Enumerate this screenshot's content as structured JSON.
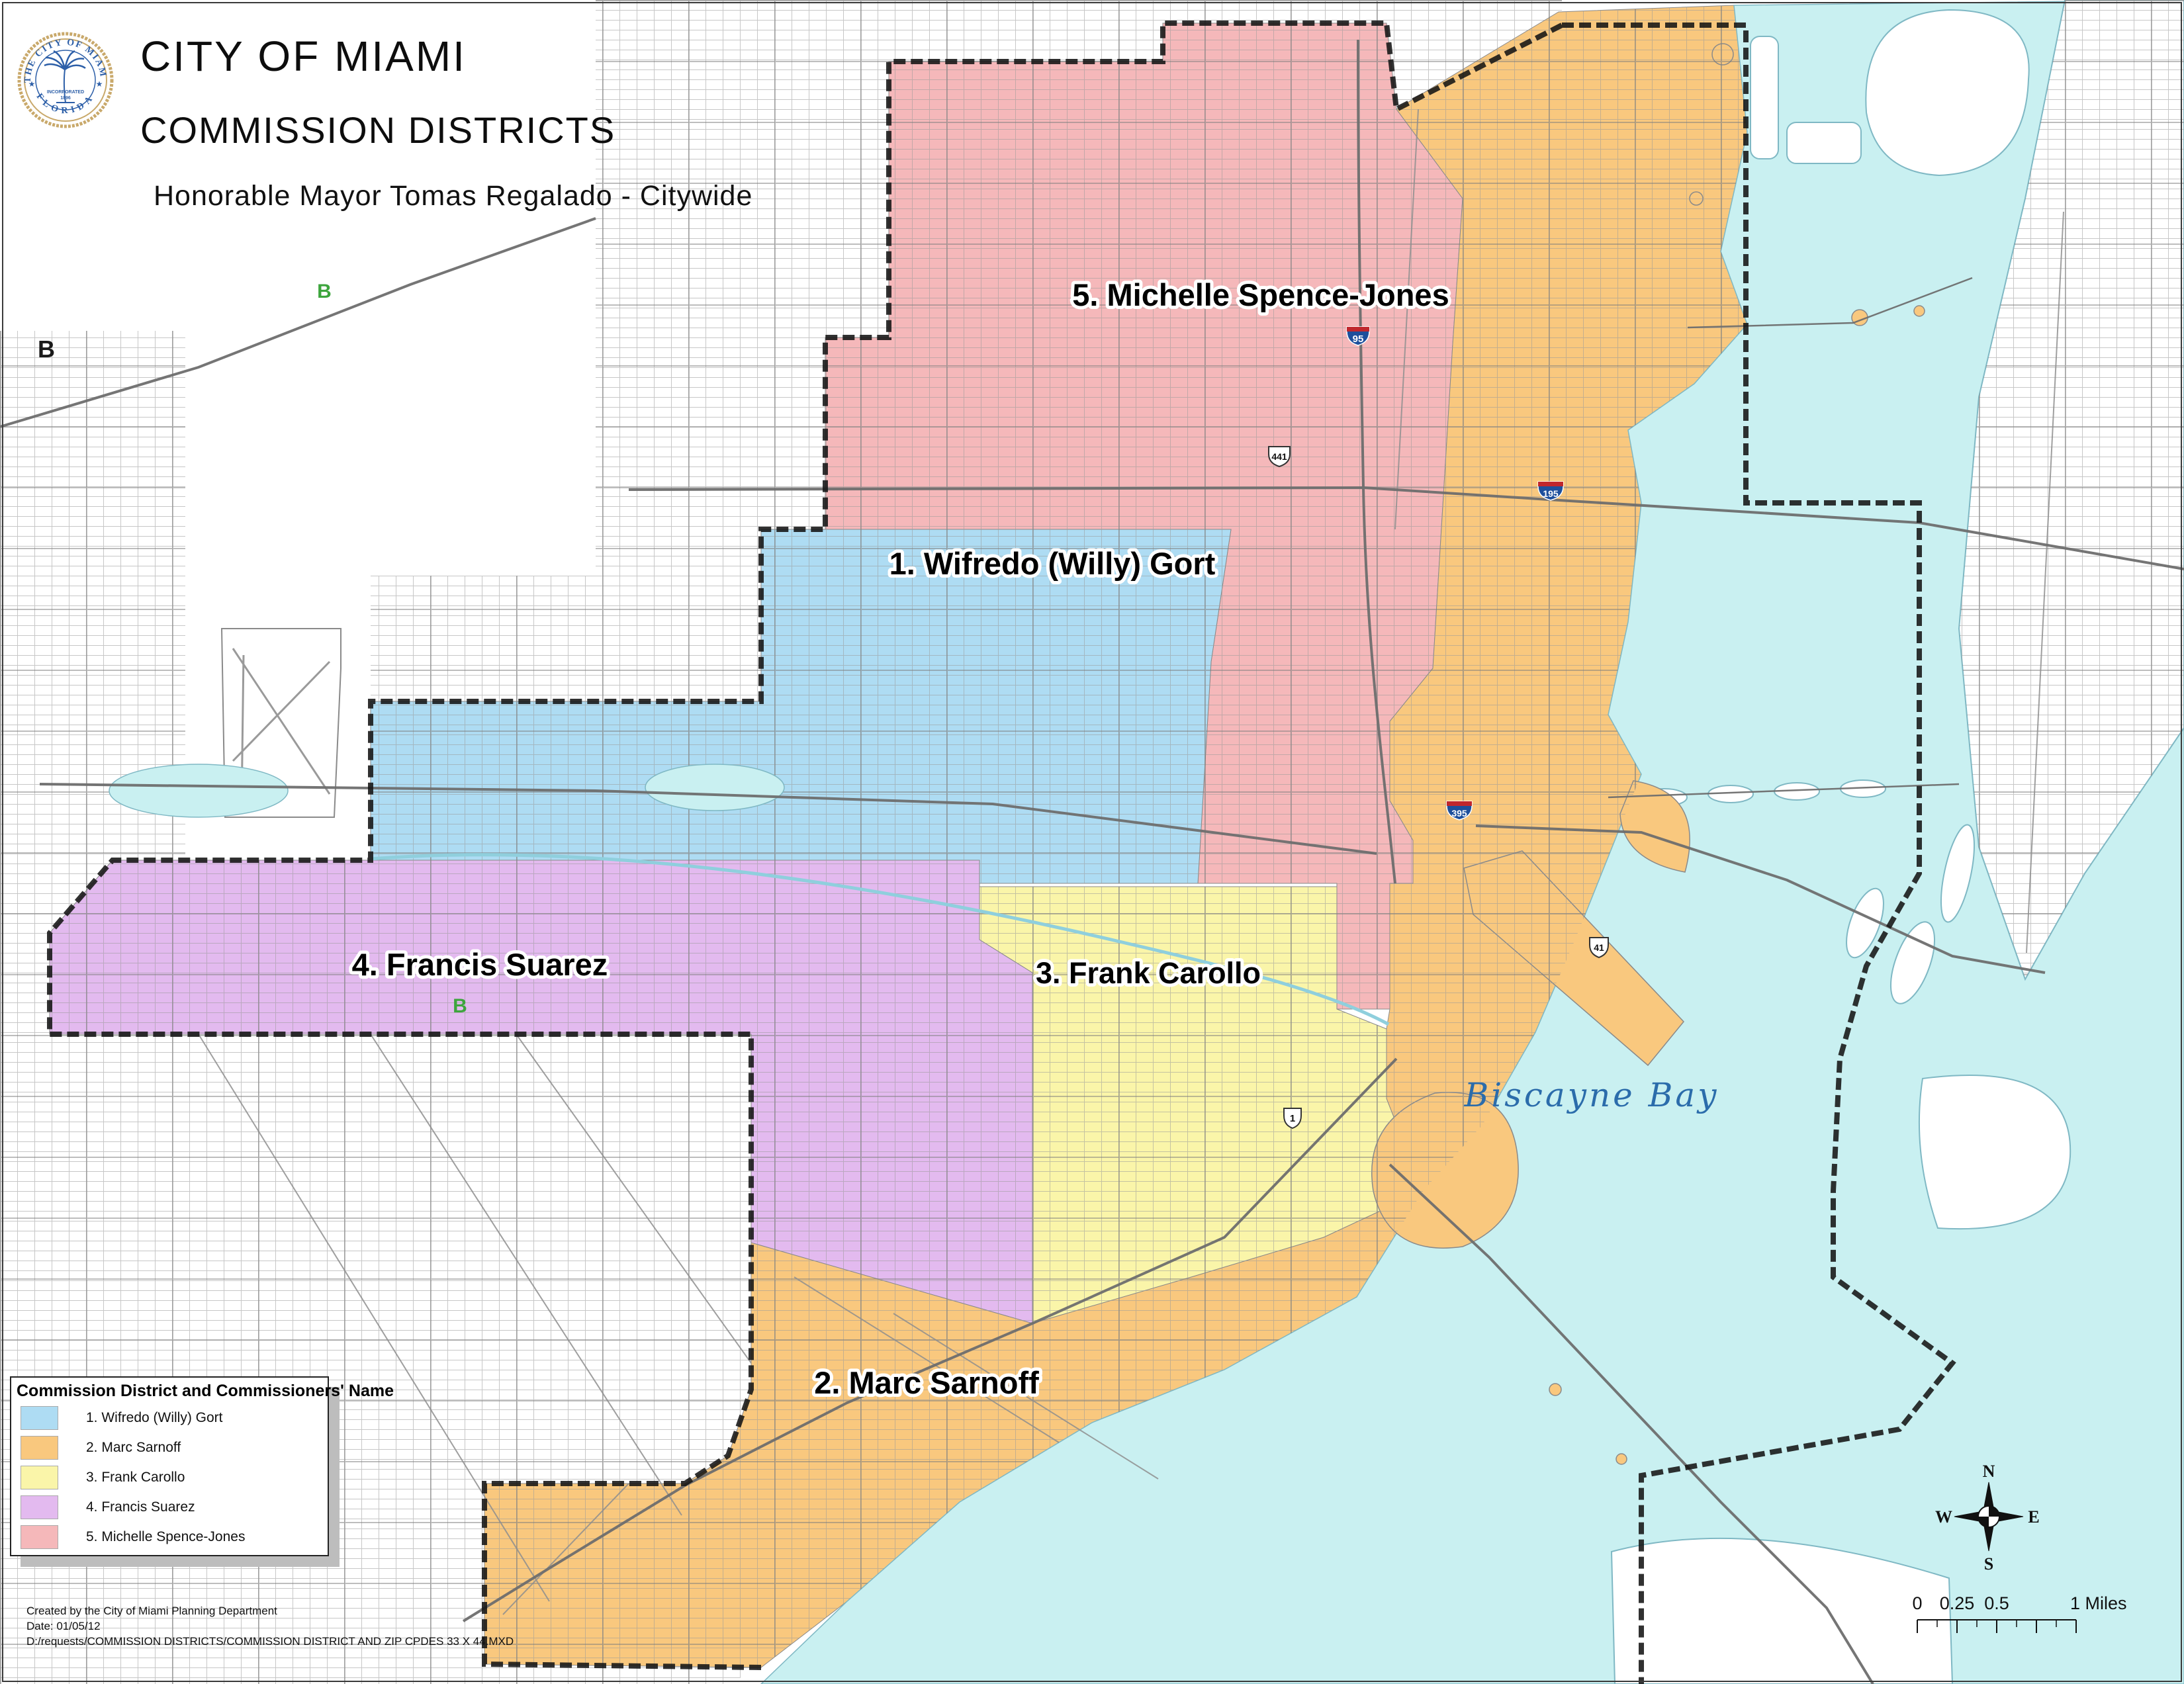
{
  "header": {
    "title": "CITY OF MIAMI",
    "subtitle": "COMMISSION DISTRICTS",
    "mayor_line": "Honorable Mayor Tomas Regalado - Citywide",
    "seal": {
      "ring_text_top": "THE CITY OF MIAMI",
      "ring_text_bottom": "FLORIDA",
      "center_line1": "INCORPORATED",
      "center_line2": "1896"
    }
  },
  "map": {
    "water_color": "#C9F0F1",
    "boundary_color": "#151515",
    "street_color": "#9a9a9a",
    "bay_label": "Biscayne Bay",
    "bay_label_color": "#2B6CAB",
    "districts": [
      {
        "id": 1,
        "label": "1. Wifredo (Willy) Gort",
        "color": "#AEDCF3"
      },
      {
        "id": 2,
        "label": "2. Marc Sarnoff",
        "color": "#F9C87E"
      },
      {
        "id": 3,
        "label": "3. Frank Carollo",
        "color": "#FAF5A9"
      },
      {
        "id": 4,
        "label": "4. Francis Suarez",
        "color": "#E3BAEF"
      },
      {
        "id": 5,
        "label": "5. Michelle Spence-Jones",
        "color": "#F5B8BA"
      }
    ],
    "shields": [
      {
        "type": "interstate",
        "label": "95"
      },
      {
        "type": "interstate",
        "label": "195"
      },
      {
        "type": "interstate",
        "label": "395"
      },
      {
        "type": "us",
        "label": "441"
      },
      {
        "type": "us",
        "label": "41"
      },
      {
        "type": "us",
        "label": "1"
      }
    ],
    "markers": [
      {
        "label": "B",
        "color": "#1a1a1a"
      },
      {
        "label": "B",
        "color": "#3DA53D"
      },
      {
        "label": "B",
        "color": "#3DA53D"
      }
    ]
  },
  "legend": {
    "title": "Commission District and Commissioners' Name",
    "items": [
      {
        "label": "1. Wifredo (Willy) Gort",
        "color": "#AEDCF3"
      },
      {
        "label": "2. Marc Sarnoff",
        "color": "#F9C87E"
      },
      {
        "label": "3. Frank Carollo",
        "color": "#FAF5A9"
      },
      {
        "label": "4. Francis Suarez",
        "color": "#E3BAEF"
      },
      {
        "label": "5. Michelle Spence-Jones",
        "color": "#F5B8BA"
      }
    ]
  },
  "credits": {
    "line1": "Created by the City of Miami Planning Department",
    "line2": "Date: 01/05/12",
    "line3": "D:/requests/COMMISSION DISTRICTS/COMMISSION DISTRICT AND ZIP CPDES 33 X 44.MXD"
  },
  "scalebar": {
    "t0": "0",
    "t1": "0.25",
    "t2": "0.5",
    "t3": "1 Miles"
  },
  "compass": {
    "n": "N",
    "s": "S",
    "e": "E",
    "w": "W"
  }
}
